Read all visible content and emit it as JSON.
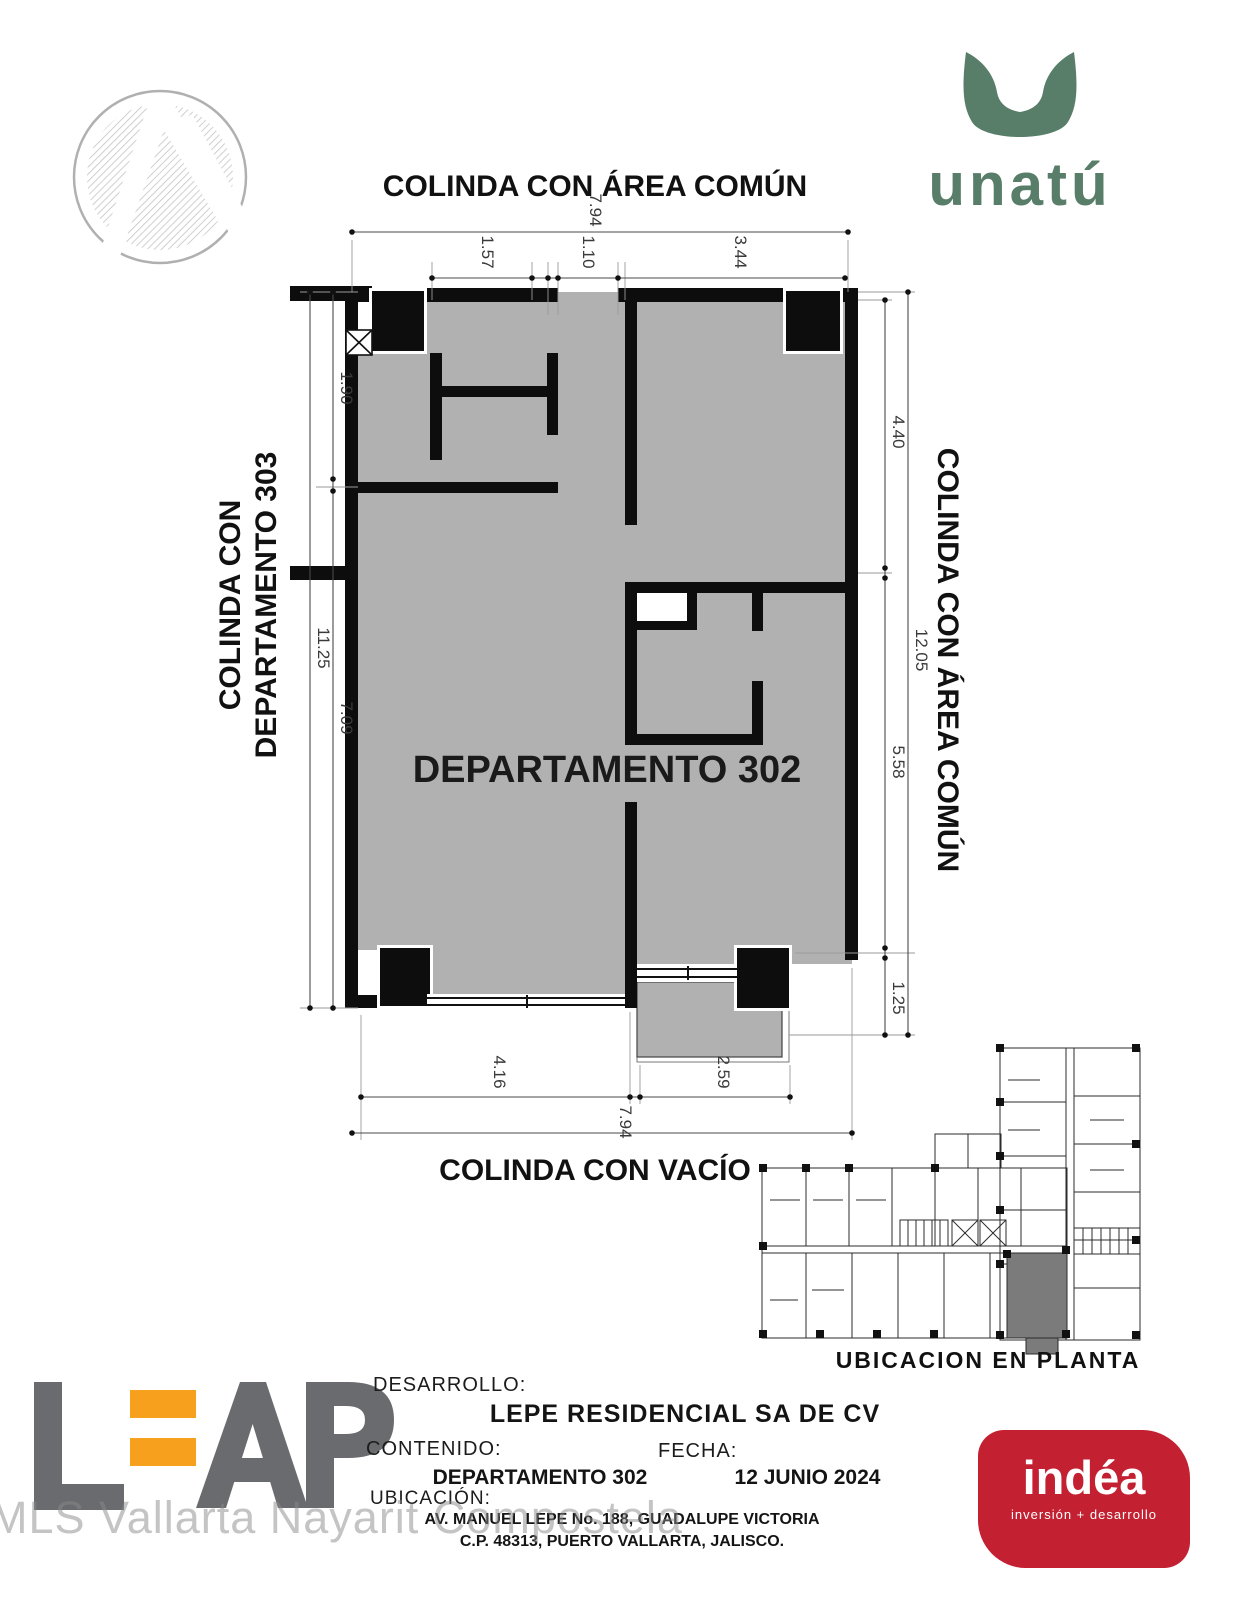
{
  "header": {
    "architect_logo": "hatched-circle-mark",
    "brand": {
      "name": "unatú",
      "color": "#587e69",
      "symbol": "tulip-u-icon"
    }
  },
  "plan": {
    "unit_label": "DEPARTAMENTO 302",
    "boundary_top": "COLINDA CON ÁREA COMÚN",
    "boundary_left_line1": "COLINDA CON",
    "boundary_left_line2": "DEPARTAMENTO 303",
    "boundary_right": "COLINDA CON ÁREA COMÚN",
    "boundary_bottom": "COLINDA CON VACÍO",
    "floor_color": "#b1b1b1",
    "highlight_color": "#7b7b7b",
    "dims": {
      "top_total": "7.94",
      "top_a": "1.57",
      "top_b": "1.10",
      "top_c": "3.44",
      "left_a": "1.90",
      "left_total": "11.25",
      "left_b": "7.09",
      "right_a": "4.40",
      "right_total": "12.05",
      "right_b": "5.58",
      "right_c": "1.25",
      "bottom_a": "4.16",
      "bottom_b": "2.59",
      "bottom_total": "7.94"
    }
  },
  "site_plan": {
    "caption": "UBICACION EN PLANTA"
  },
  "title_block": {
    "desarrollo_label": "DESARROLLO:",
    "desarrollo_value": "LEPE RESIDENCIAL SA DE CV",
    "contenido_label": "CONTENIDO:",
    "contenido_value": "DEPARTAMENTO 302",
    "fecha_label": "FECHA:",
    "fecha_value": "12 JUNIO 2024",
    "ubicacion_label": "UBICACIÓN:",
    "ubicacion_line1": "AV. MANUEL LEPE No. 188, GUADALUPE VICTORIA",
    "ubicacion_line2": "C.P. 48313, PUERTO VALLARTA, JALISCO."
  },
  "footer_brands": {
    "leap": {
      "text": "LEAP",
      "gray": "#6a6b6e",
      "accent": "#f6a01e"
    },
    "indea": {
      "name": "indéa",
      "tagline": "inversión + desarrollo",
      "bg": "#c32032"
    }
  },
  "watermark": "MLS Vallarta Nayarit Compostela"
}
